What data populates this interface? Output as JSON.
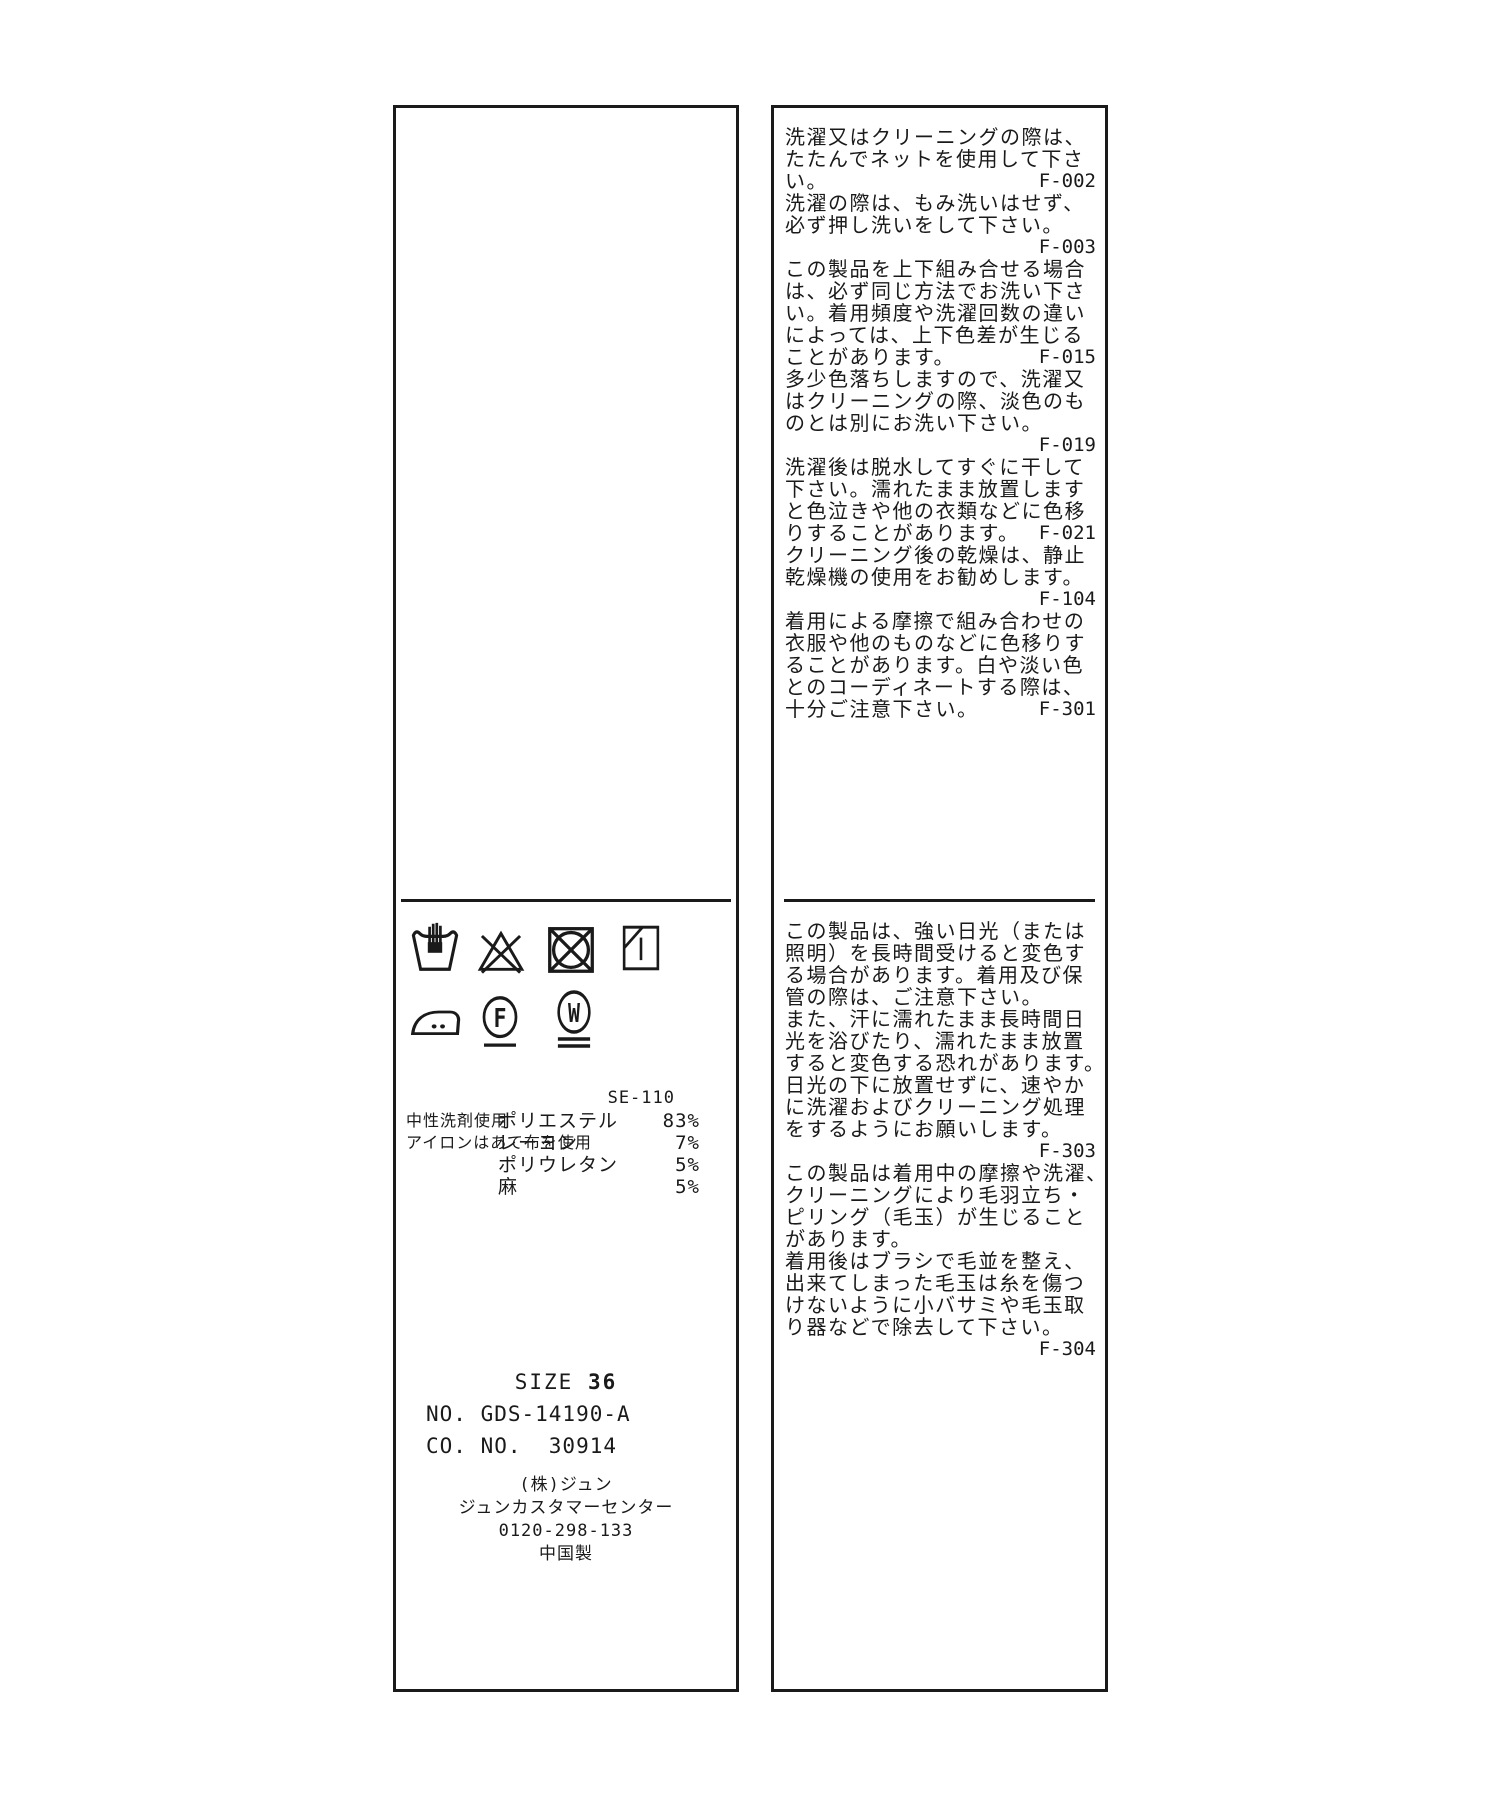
{
  "page": {
    "background": "#ffffff",
    "ink": "#1a1a1a"
  },
  "left_panel": {
    "care_symbol_names_row1": [
      "hand-wash",
      "do-not-bleach",
      "do-not-tumble-dry",
      "line-dry-in-shade"
    ],
    "care_symbol_names_row2": [
      "iron-medium-two-dots",
      "dry-clean-petroleum-F",
      "wet-clean-W"
    ],
    "notes": [
      "中性洗剤使用",
      "アイロンはあて布を使用"
    ],
    "ref_code": "SE-110",
    "composition": [
      {
        "material": "ポリエステル",
        "percent": "83%"
      },
      {
        "material": "レーヨン",
        "percent": "7%"
      },
      {
        "material": "ポリウレタン",
        "percent": "5%"
      },
      {
        "material": "麻",
        "percent": "5%"
      }
    ],
    "size_label": "SIZE",
    "size_value": "36",
    "item_no": "NO. GDS-14190-A",
    "co_no": "CO. NO.  30914",
    "company": [
      "(株)ジュン",
      "ジュンカスタマーセンター",
      "0120-298-133",
      "中国製"
    ]
  },
  "right_panel": {
    "top_lines": [
      {
        "text": "洗濯又はクリーニングの際は、",
        "code": ""
      },
      {
        "text": "たたんでネットを使用して下さ",
        "code": ""
      },
      {
        "text": "い。",
        "code": "F-002"
      },
      {
        "text": "洗濯の際は、もみ洗いはせず、",
        "code": ""
      },
      {
        "text": "必ず押し洗いをして下さい。",
        "code": ""
      },
      {
        "text": "",
        "code": "F-003"
      },
      {
        "text": "この製品を上下組み合せる場合",
        "code": ""
      },
      {
        "text": "は、必ず同じ方法でお洗い下さ",
        "code": ""
      },
      {
        "text": "い。着用頻度や洗濯回数の違い",
        "code": ""
      },
      {
        "text": "によっては、上下色差が生じる",
        "code": ""
      },
      {
        "text": "ことがあります。",
        "code": "F-015"
      },
      {
        "text": "多少色落ちしますので、洗濯又",
        "code": ""
      },
      {
        "text": "はクリーニングの際、淡色のも",
        "code": ""
      },
      {
        "text": "のとは別にお洗い下さい。",
        "code": ""
      },
      {
        "text": "",
        "code": "F-019"
      },
      {
        "text": "洗濯後は脱水してすぐに干して",
        "code": ""
      },
      {
        "text": "下さい。濡れたまま放置します",
        "code": ""
      },
      {
        "text": "と色泣きや他の衣類などに色移",
        "code": ""
      },
      {
        "text": "りすることがあります。",
        "code": "F-021"
      },
      {
        "text": "クリーニング後の乾燥は、静止",
        "code": ""
      },
      {
        "text": "乾燥機の使用をお勧めします。",
        "code": ""
      },
      {
        "text": "",
        "code": "F-104"
      },
      {
        "text": "着用による摩擦で組み合わせの",
        "code": ""
      },
      {
        "text": "衣服や他のものなどに色移りす",
        "code": ""
      },
      {
        "text": "ることがあります。白や淡い色",
        "code": ""
      },
      {
        "text": "とのコーディネートする際は、",
        "code": ""
      },
      {
        "text": "十分ご注意下さい。",
        "code": "F-301"
      }
    ],
    "bottom_lines": [
      {
        "text": "この製品は、強い日光（または",
        "code": ""
      },
      {
        "text": "照明）を長時間受けると変色す",
        "code": ""
      },
      {
        "text": "る場合があります。着用及び保",
        "code": ""
      },
      {
        "text": "管の際は、ご注意下さい。",
        "code": ""
      },
      {
        "text": "また、汗に濡れたまま長時間日",
        "code": ""
      },
      {
        "text": "光を浴びたり、濡れたまま放置",
        "code": ""
      },
      {
        "text": "すると変色する恐れがあります。",
        "code": ""
      },
      {
        "text": "日光の下に放置せずに、速やか",
        "code": ""
      },
      {
        "text": "に洗濯およびクリーニング処理",
        "code": ""
      },
      {
        "text": "をするようにお願いします。",
        "code": ""
      },
      {
        "text": "",
        "code": "F-303"
      },
      {
        "text": "この製品は着用中の摩擦や洗濯、",
        "code": ""
      },
      {
        "text": "クリーニングにより毛羽立ち・",
        "code": ""
      },
      {
        "text": "ピリング（毛玉）が生じること",
        "code": ""
      },
      {
        "text": "があります。",
        "code": ""
      },
      {
        "text": "着用後はブラシで毛並を整え、",
        "code": ""
      },
      {
        "text": "出来てしまった毛玉は糸を傷つ",
        "code": ""
      },
      {
        "text": "けないように小バサミや毛玉取",
        "code": ""
      },
      {
        "text": "り器などで除去して下さい。",
        "code": ""
      },
      {
        "text": "",
        "code": "F-304"
      }
    ]
  }
}
